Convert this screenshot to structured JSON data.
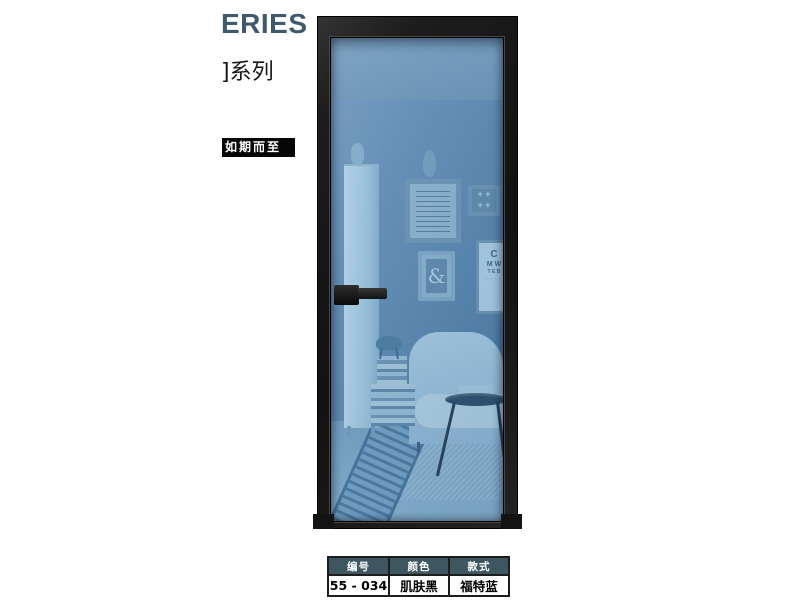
{
  "poster": {
    "series_title": "ERIES",
    "series_subtitle": "]系列",
    "tagline": "如期而至"
  },
  "spec_table": {
    "columns": [
      "编号",
      "颜色",
      "款式"
    ],
    "values": [
      "55 - 034",
      "肌肤黑",
      "福特蓝"
    ]
  },
  "scene": {
    "ampersand": "&",
    "plus_row1": "+ +",
    "plus_row2": "+ +",
    "eyechart": {
      "l1": "C",
      "l2": "M W",
      "l3": "T E B",
      "l4": "· · · ·"
    }
  },
  "colors": {
    "accent_slate": "#3e5a6c",
    "table_header_bg": "#3d5660",
    "door_frame_black": "#1a1a1a",
    "glass_blue": "#5d8ab0",
    "tagline_bg": "#060606"
  }
}
